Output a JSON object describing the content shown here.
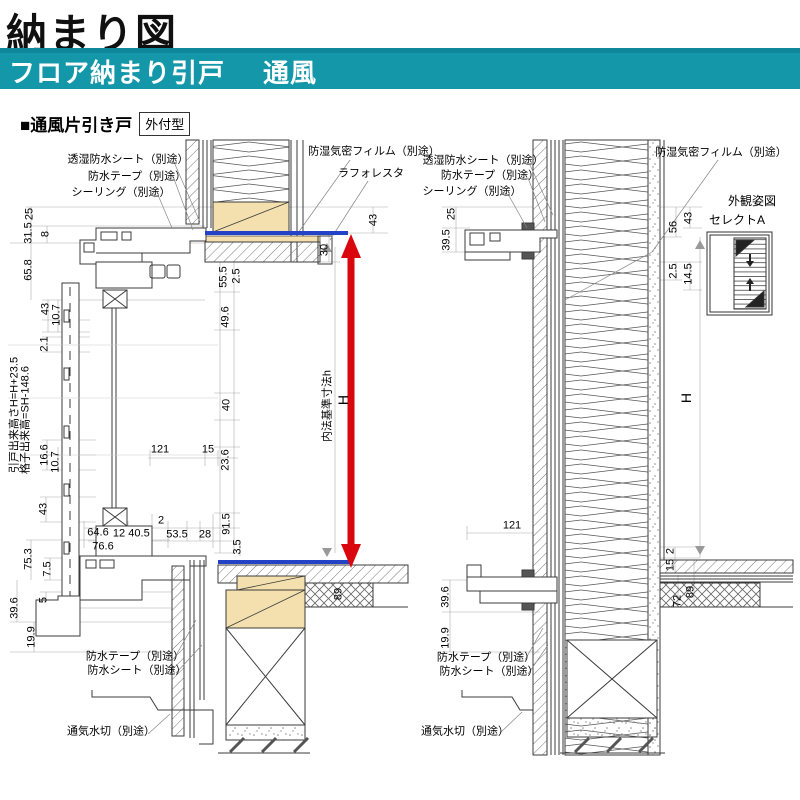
{
  "page": {
    "title": "納まり図",
    "banner": {
      "title": "フロア納まり引戸",
      "subtitle": "通風"
    },
    "section": {
      "heading": "■通風片引き戸",
      "tag": "外付型"
    }
  },
  "colors": {
    "banner_teal": "#1597AA",
    "floor_line_blue": "#2342C6",
    "height_arrow_red": "#D9070D",
    "wood_tan": "#F4E0AE",
    "line_dark": "#3B3B3B"
  },
  "drawings": [
    {
      "id": "left-section",
      "labels": [
        {
          "t": "透湿防水シート（別途）",
          "x": 128,
          "y": 160,
          "kind": "note"
        },
        {
          "t": "防水テープ（別途）",
          "x": 137,
          "y": 177,
          "kind": "note"
        },
        {
          "t": "シーリング（別途）",
          "x": 121,
          "y": 193,
          "kind": "note"
        },
        {
          "t": "防湿気密フィルム（別途）",
          "x": 374,
          "y": 152,
          "kind": "note"
        },
        {
          "t": "ラフォレスタ",
          "x": 371,
          "y": 174,
          "kind": "note"
        },
        {
          "t": "防水テープ（別途）",
          "x": 135,
          "y": 657,
          "kind": "note"
        },
        {
          "t": "防水シート（別途）",
          "x": 137,
          "y": 671,
          "kind": "note"
        },
        {
          "t": "通気水切（別途）",
          "x": 111,
          "y": 732,
          "kind": "note"
        },
        {
          "t": "内法基準寸法h",
          "x": 328,
          "y": 406,
          "r": -90,
          "kind": "note"
        },
        {
          "t": "H",
          "x": 343,
          "y": 400,
          "r": -90,
          "s": 14,
          "kind": "dim"
        },
        {
          "t": "25",
          "x": 30,
          "y": 214,
          "r": -90,
          "kind": "dim"
        },
        {
          "t": "31.5",
          "x": 29,
          "y": 233,
          "r": -90,
          "kind": "dim"
        },
        {
          "t": "8",
          "x": 46,
          "y": 234,
          "r": -90,
          "kind": "dim"
        },
        {
          "t": "65.8",
          "x": 29,
          "y": 270,
          "r": -90,
          "kind": "dim"
        },
        {
          "t": "43",
          "x": 46,
          "y": 309,
          "r": -90,
          "kind": "dim"
        },
        {
          "t": "10.7",
          "x": 57,
          "y": 315,
          "r": -90,
          "kind": "dim"
        },
        {
          "t": "2.1",
          "x": 45,
          "y": 344,
          "r": -90,
          "kind": "dim"
        },
        {
          "t": "引戸出来高さH=H+23.5",
          "x": 15,
          "y": 415,
          "r": -90,
          "kind": "dim"
        },
        {
          "t": "格子出来高=SH-148.6",
          "x": 26,
          "y": 420,
          "r": -90,
          "kind": "dim"
        },
        {
          "t": "16.6",
          "x": 45,
          "y": 455,
          "r": -90,
          "kind": "dim"
        },
        {
          "t": "10.7",
          "x": 56,
          "y": 462,
          "r": -90,
          "kind": "dim"
        },
        {
          "t": "43",
          "x": 44,
          "y": 509,
          "r": -90,
          "kind": "dim"
        },
        {
          "t": "75.3",
          "x": 29,
          "y": 559,
          "r": -90,
          "kind": "dim"
        },
        {
          "t": "7.5",
          "x": 48,
          "y": 569,
          "r": -90,
          "kind": "dim"
        },
        {
          "t": "5",
          "x": 44,
          "y": 600,
          "r": -90,
          "kind": "dim"
        },
        {
          "t": "39.6",
          "x": 15,
          "y": 608,
          "r": -90,
          "kind": "dim"
        },
        {
          "t": "19.9",
          "x": 32,
          "y": 637,
          "r": -90,
          "kind": "dim"
        },
        {
          "t": "64.6",
          "x": 98,
          "y": 533,
          "kind": "dim"
        },
        {
          "t": "12",
          "x": 119,
          "y": 534,
          "kind": "dim"
        },
        {
          "t": "40.5",
          "x": 139,
          "y": 534,
          "kind": "dim"
        },
        {
          "t": "76.6",
          "x": 103,
          "y": 547,
          "kind": "dim"
        },
        {
          "t": "2",
          "x": 161,
          "y": 521,
          "kind": "dim"
        },
        {
          "t": "53.5",
          "x": 177,
          "y": 535,
          "kind": "dim"
        },
        {
          "t": "28",
          "x": 205,
          "y": 535,
          "kind": "dim"
        },
        {
          "t": "91.5",
          "x": 227,
          "y": 524,
          "r": -90,
          "kind": "dim"
        },
        {
          "t": "3.5",
          "x": 238,
          "y": 547,
          "r": -90,
          "kind": "dim"
        },
        {
          "t": "121",
          "x": 160,
          "y": 450,
          "kind": "dim"
        },
        {
          "t": "15",
          "x": 208,
          "y": 450,
          "kind": "dim"
        },
        {
          "t": "23.6",
          "x": 226,
          "y": 460,
          "r": -90,
          "kind": "dim"
        },
        {
          "t": "55.5",
          "x": 224,
          "y": 277,
          "r": -90,
          "kind": "dim"
        },
        {
          "t": "2.5",
          "x": 237,
          "y": 276,
          "r": -90,
          "kind": "dim"
        },
        {
          "t": "49.6",
          "x": 226,
          "y": 317,
          "r": -90,
          "kind": "dim"
        },
        {
          "t": "40",
          "x": 227,
          "y": 405,
          "r": -90,
          "kind": "dim"
        },
        {
          "t": "30",
          "x": 325,
          "y": 250,
          "r": -90,
          "kind": "dim"
        },
        {
          "t": "43",
          "x": 374,
          "y": 220,
          "r": -90,
          "kind": "dim"
        },
        {
          "t": "89",
          "x": 339,
          "y": 594,
          "r": -90,
          "kind": "dim"
        }
      ]
    },
    {
      "id": "right-section",
      "labels": [
        {
          "t": "透湿防水シート（別途）",
          "x": 483,
          "y": 161,
          "kind": "note"
        },
        {
          "t": "防水テープ（別途）",
          "x": 490,
          "y": 176,
          "kind": "note"
        },
        {
          "t": "シーリング（別途）",
          "x": 472,
          "y": 192,
          "kind": "note"
        },
        {
          "t": "防湿気密フィルム（別途）",
          "x": 721,
          "y": 153,
          "kind": "note"
        },
        {
          "t": "外観姿図",
          "x": 752,
          "y": 201,
          "s": 12,
          "kind": "note"
        },
        {
          "t": "セレクトA",
          "x": 737,
          "y": 220,
          "s": 12,
          "kind": "note"
        },
        {
          "t": "防水テープ（別途）",
          "x": 486,
          "y": 658,
          "kind": "note"
        },
        {
          "t": "防水シート（別途）",
          "x": 489,
          "y": 672,
          "kind": "note"
        },
        {
          "t": "通気水切（別途）",
          "x": 465,
          "y": 732,
          "kind": "note"
        },
        {
          "t": "25",
          "x": 452,
          "y": 214,
          "r": -90,
          "kind": "dim"
        },
        {
          "t": "39.5",
          "x": 447,
          "y": 240,
          "r": -90,
          "kind": "dim"
        },
        {
          "t": "56",
          "x": 674,
          "y": 227,
          "r": -90,
          "kind": "dim"
        },
        {
          "t": "43",
          "x": 689,
          "y": 218,
          "r": -90,
          "kind": "dim"
        },
        {
          "t": "2.5",
          "x": 674,
          "y": 271,
          "r": -90,
          "kind": "dim"
        },
        {
          "t": "14.5",
          "x": 689,
          "y": 274,
          "r": -90,
          "kind": "dim"
        },
        {
          "t": "H",
          "x": 686,
          "y": 398,
          "r": -90,
          "s": 14,
          "kind": "dim"
        },
        {
          "t": "121",
          "x": 512,
          "y": 526,
          "kind": "dim"
        },
        {
          "t": "39.6",
          "x": 446,
          "y": 597,
          "r": -90,
          "kind": "dim"
        },
        {
          "t": "19.9",
          "x": 446,
          "y": 638,
          "r": -90,
          "kind": "dim"
        },
        {
          "t": "2",
          "x": 671,
          "y": 551,
          "r": -90,
          "kind": "dim"
        },
        {
          "t": "15",
          "x": 671,
          "y": 565,
          "r": -90,
          "kind": "dim"
        },
        {
          "t": "72",
          "x": 678,
          "y": 601,
          "r": -90,
          "kind": "dim"
        },
        {
          "t": "89",
          "x": 691,
          "y": 592,
          "r": -90,
          "kind": "dim"
        }
      ]
    }
  ]
}
